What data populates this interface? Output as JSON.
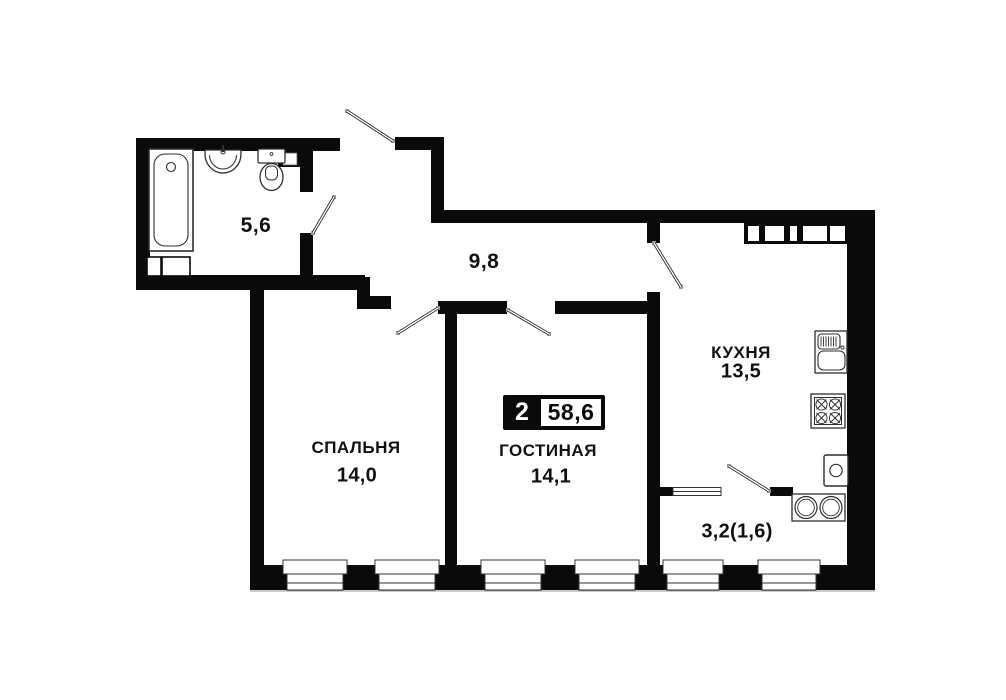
{
  "plan": {
    "badge": {
      "rooms": "2",
      "total_area": "58,6"
    },
    "rooms": {
      "bathroom": {
        "area": "5,6"
      },
      "hallway": {
        "area": "9,8"
      },
      "bedroom": {
        "name": "СПАЛЬНЯ",
        "area": "14,0"
      },
      "living": {
        "name": "ГОСТИНАЯ",
        "area": "14,1"
      },
      "kitchen": {
        "name": "КУХНЯ",
        "area": "13,5"
      },
      "balcony": {
        "area": "3,2(1,6)"
      }
    },
    "colors": {
      "wall": "#0a0a0a",
      "background": "#ffffff",
      "fixture_line": "#2e2e2e"
    }
  }
}
